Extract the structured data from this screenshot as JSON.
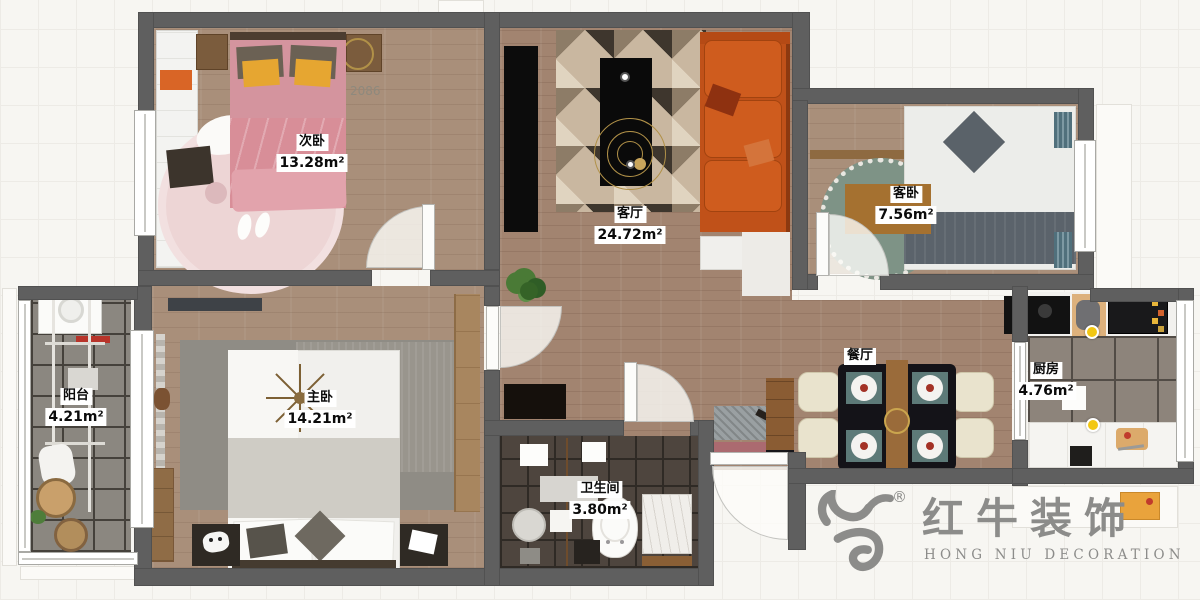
{
  "floorplan": {
    "rooms": [
      {
        "name": "次卧",
        "area": "13.28m²"
      },
      {
        "name": "客厅",
        "area": "24.72m²"
      },
      {
        "name": "客卧",
        "area": "7.56m²"
      },
      {
        "name": "阳台",
        "area": "4.21m²"
      },
      {
        "name": "主卧",
        "area": "14.21m²"
      },
      {
        "name": "餐厅",
        "area": ""
      },
      {
        "name": "厨房",
        "area": "4.76m²"
      },
      {
        "name": "卫生间",
        "area": "3.80m²"
      }
    ],
    "annotations": {
      "bed_width": "2086"
    },
    "logo": {
      "registered": "®",
      "name_cn": "红牛装饰",
      "name_en": "HONG NIU DECORATION"
    },
    "colors": {
      "wall": "#5f5f5f",
      "wood_floor": "#a28470",
      "sofa_orange": "#c05119",
      "bed_pink": "#d4949e",
      "pillow_yellow": "#e6a631",
      "rug_green": "#7e9386",
      "marker_yellow": "#f2c713",
      "label_bg": "#ffffff",
      "logo_gray": "#8c8c8a"
    }
  }
}
